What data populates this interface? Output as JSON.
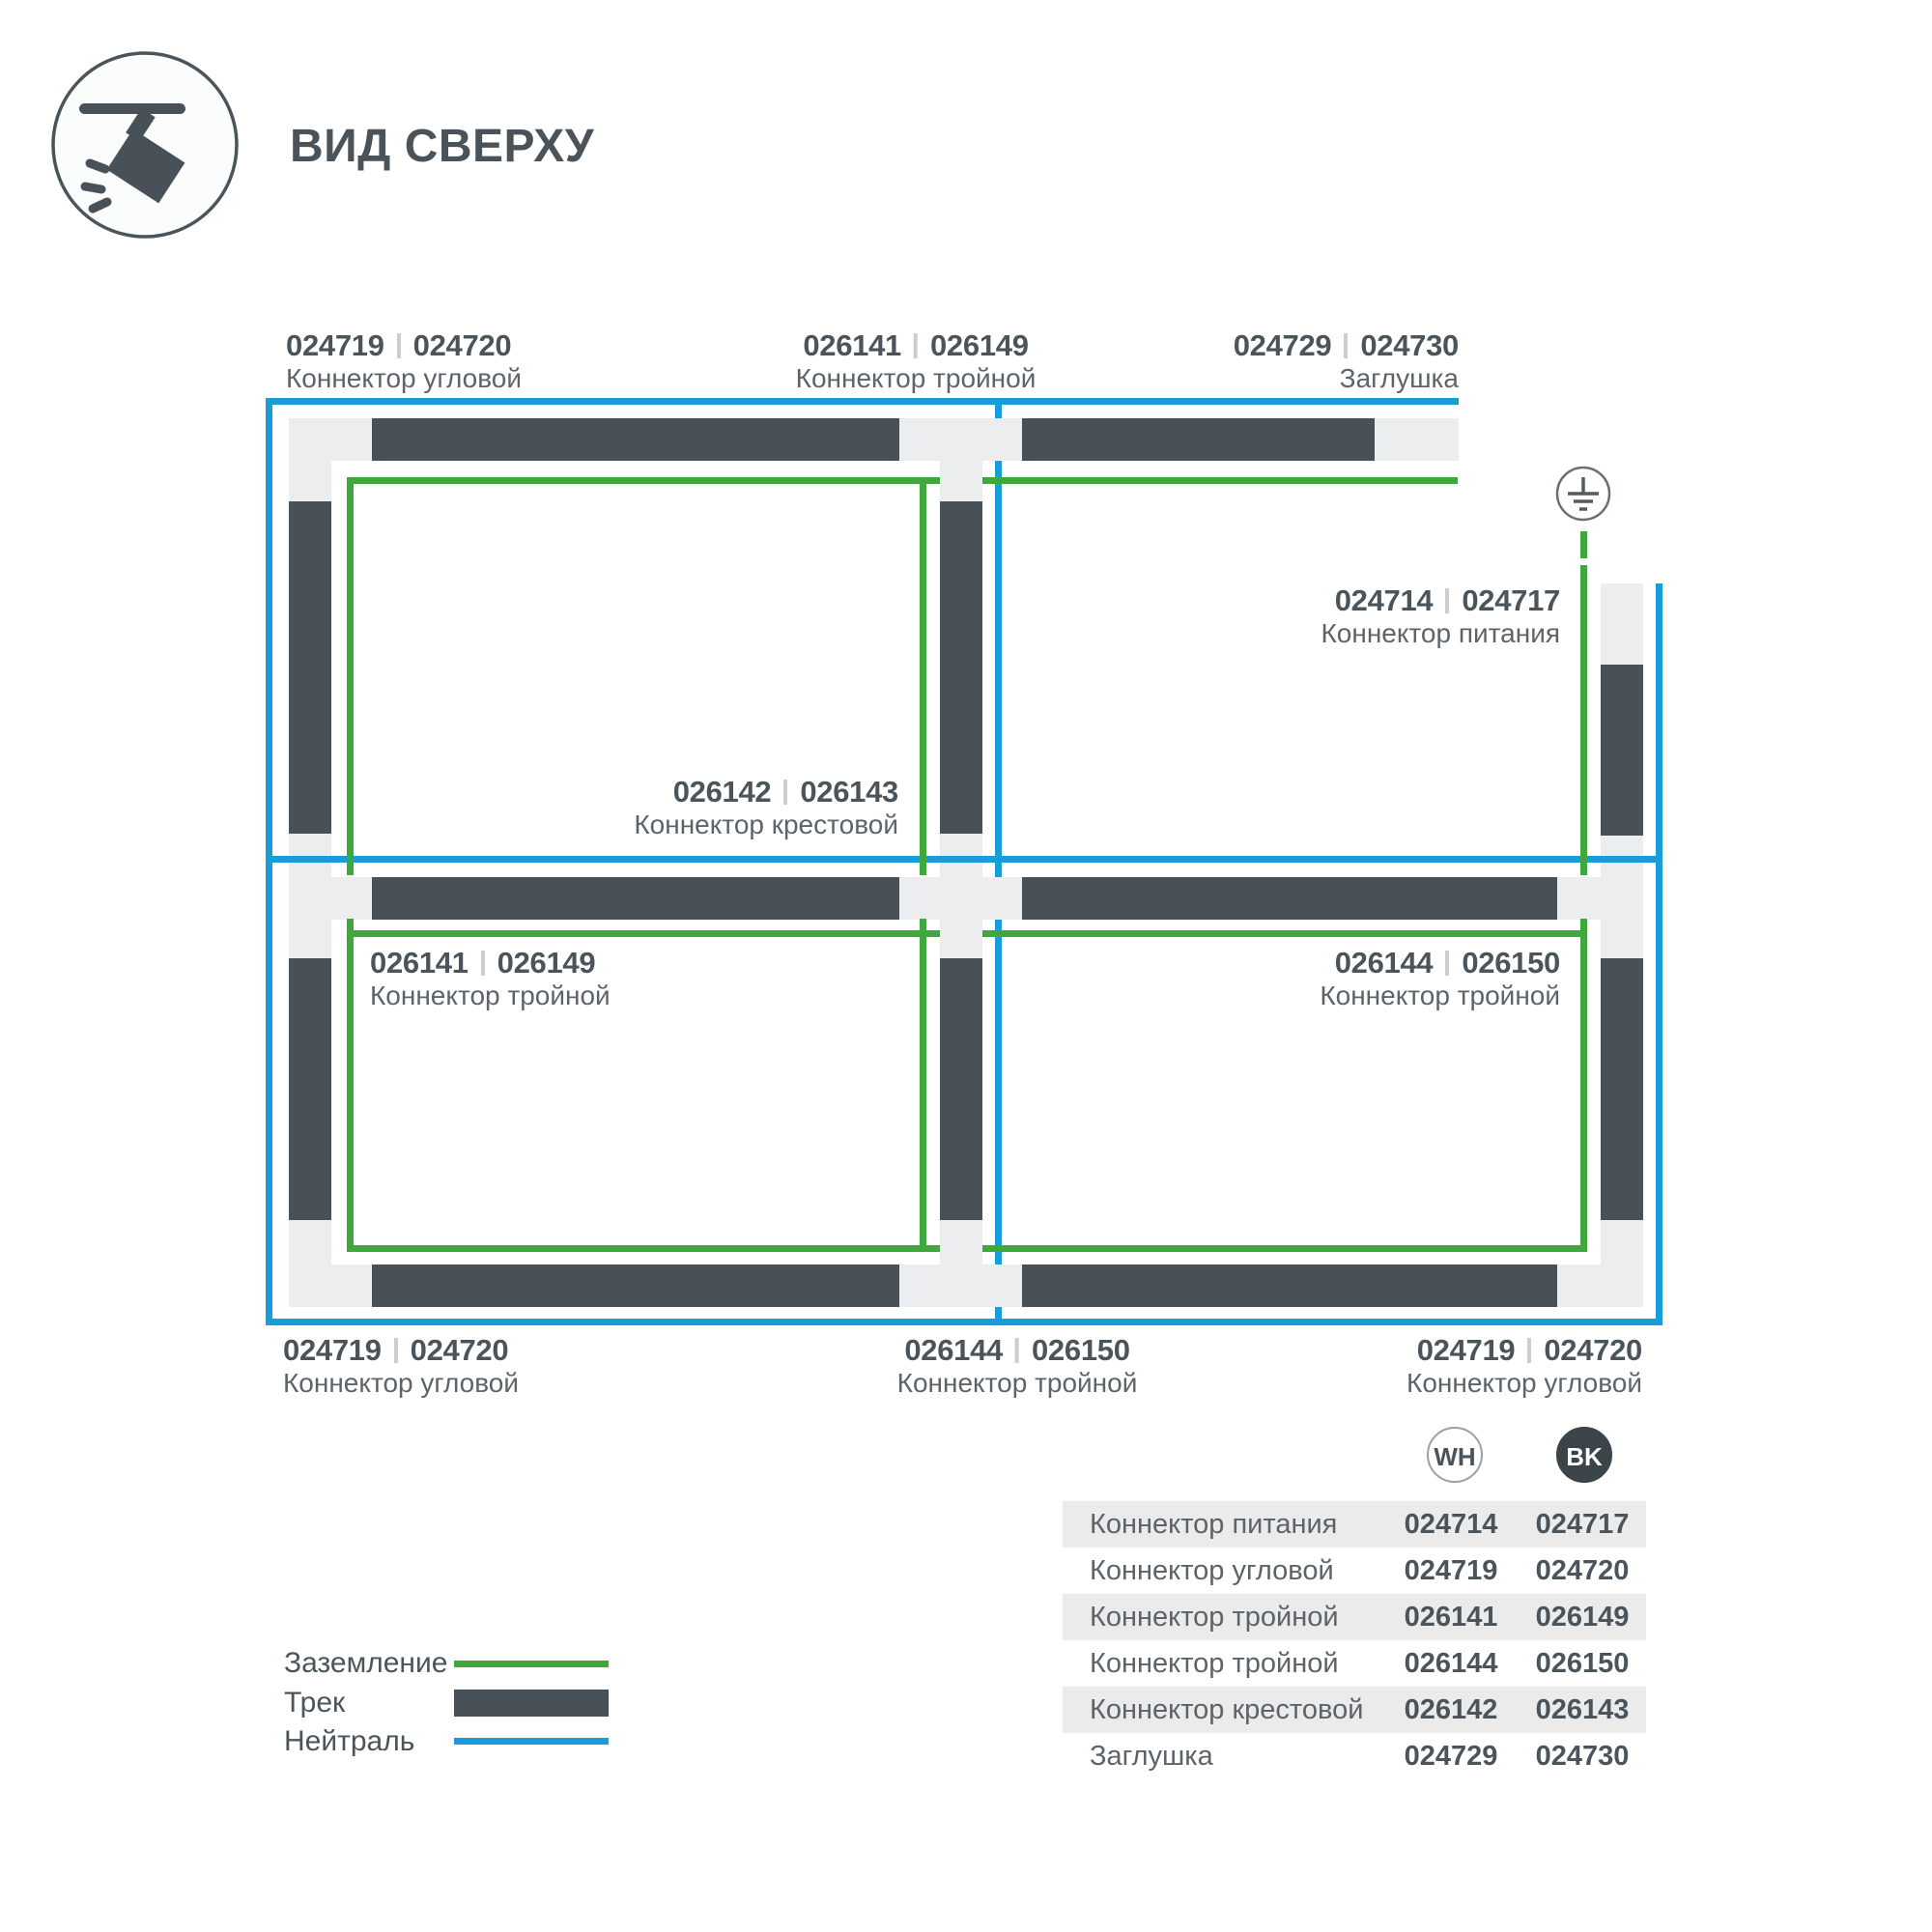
{
  "title": "ВИД СВЕРХУ",
  "diagram": {
    "labels": {
      "top_left": {
        "code_wh": "024719",
        "code_bk": "024720",
        "name": "Коннектор угловой"
      },
      "top_center": {
        "code_wh": "026141",
        "code_bk": "026149",
        "name": "Коннектор тройной"
      },
      "top_right": {
        "code_wh": "024729",
        "code_bk": "024730",
        "name": "Заглушка"
      },
      "power": {
        "code_wh": "024714",
        "code_bk": "024717",
        "name": "Коннектор питания"
      },
      "cross": {
        "code_wh": "026142",
        "code_bk": "026143",
        "name": "Коннектор крестовой"
      },
      "mid_left": {
        "code_wh": "026141",
        "code_bk": "026149",
        "name": "Коннектор тройной"
      },
      "mid_right": {
        "code_wh": "026144",
        "code_bk": "026150",
        "name": "Коннектор тройной"
      },
      "bottom_left": {
        "code_wh": "024719",
        "code_bk": "024720",
        "name": "Коннектор угловой"
      },
      "bottom_center": {
        "code_wh": "026144",
        "code_bk": "026150",
        "name": "Коннектор тройной"
      },
      "bottom_right": {
        "code_wh": "024719",
        "code_bk": "024720",
        "name": "Коннектор угловой"
      }
    }
  },
  "legend": {
    "ground": "Заземление",
    "track": "Трек",
    "neutral": "Нейтраль"
  },
  "table": {
    "headers": {
      "wh": "WH",
      "bk": "BK"
    },
    "rows": [
      {
        "name": "Коннектор питания",
        "wh": "024714",
        "bk": "024717"
      },
      {
        "name": "Коннектор угловой",
        "wh": "024719",
        "bk": "024720"
      },
      {
        "name": "Коннектор тройной",
        "wh": "026141",
        "bk": "026149"
      },
      {
        "name": "Коннектор тройной",
        "wh": "026144",
        "bk": "026150"
      },
      {
        "name": "Коннектор крестовой",
        "wh": "026142",
        "bk": "026143"
      },
      {
        "name": "Заглушка",
        "wh": "024729",
        "bk": "024730"
      }
    ]
  },
  "colors": {
    "track_dark": "#485157",
    "track_light": "#ebedee",
    "ground_green": "#3fa73d",
    "neutral_blue": "#189dd9",
    "text_primary": "#4b545a",
    "text_secondary": "#5c646a",
    "table_stripe": "#ebebeb",
    "bk_badge": "#3b4449"
  }
}
